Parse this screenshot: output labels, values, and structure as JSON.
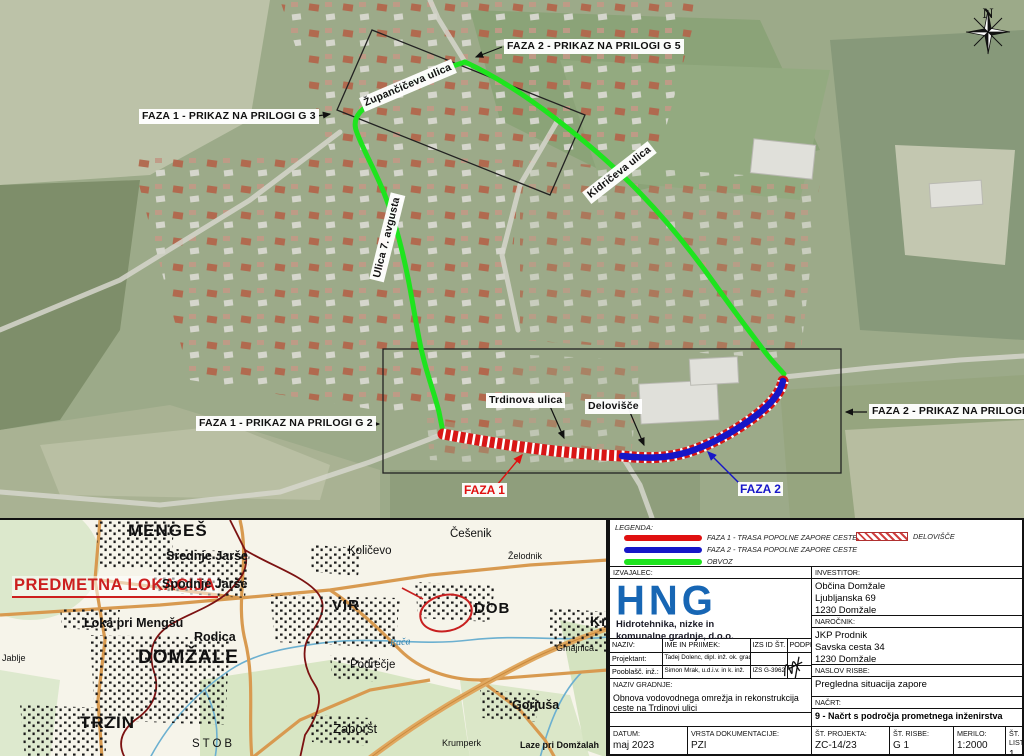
{
  "aerial": {
    "labels": {
      "faza2_g5": "FAZA 2 - PRIKAZ NA PRILOGI G 5",
      "faza1_g3": "FAZA 1 - PRIKAZ NA PRILOGI G 3",
      "faza1_g2": "FAZA 1 - PRIKAZ NA PRILOGI G 2",
      "faza2_g4": "FAZA 2 - PRIKAZ NA PRILOGI G 4",
      "street_zupanciceva": "Župančičeva ulica",
      "street_kidriceva": "Kidričeva ulica",
      "street_ulica7": "Ulica 7. avgusta",
      "street_trdinova": "Trdinova ulica",
      "delovisce": "Delovišče",
      "faza1": "FAZA 1",
      "faza2": "FAZA 2",
      "north": "N"
    },
    "colors": {
      "obvoz": "#1ee41e",
      "faza1": "#e01010",
      "faza2": "#1616c8"
    }
  },
  "map": {
    "highlight": "PREDMETNA LOKACIJA",
    "places": [
      "MENGEŠ",
      "Srednje Jarše",
      "Spodnje Jarše",
      "Količevo",
      "Češenik",
      "Želodnik",
      "Loka pri Mengšu",
      "Rodica",
      "VIR",
      "DOB",
      "Krtina",
      "DOMŽALE",
      "Podrečje",
      "Gmajnica",
      "TRZIN",
      "Zaboršt",
      "Gorjuša",
      "STOB",
      "Laze pri Domžalah",
      "Krumperk",
      "Rača",
      "Jablje"
    ]
  },
  "legend": {
    "title": "LEGENDA:",
    "items": [
      {
        "label": "FAZA 1 - TRASA POPOLNE ZAPORE CESTE",
        "color": "#e01010"
      },
      {
        "label": "FAZA 2 - TRASA POPOLNE ZAPORE CESTE",
        "color": "#1616c8"
      },
      {
        "label": "OBVOZ",
        "color": "#1ee41e"
      },
      {
        "label": "DELOVIŠČE",
        "swatch": "hatched"
      }
    ]
  },
  "titleblock": {
    "izvajalec_label": "IZVAJALEC:",
    "logo_text": "HNG",
    "logo_sub1": "Hidrotehnika, nizke in",
    "logo_sub2": "komunalne gradnje, d.o.o.",
    "investitor_label": "INVESTITOR:",
    "investitor1": "Občina Domžale",
    "investitor2": "Ljubljanska 69",
    "investitor3": "1230 Domžale",
    "narocnik_label": "NAROČNIK:",
    "narocnik1": "JKP Prodnik",
    "narocnik2": "Savska cesta 34",
    "narocnik3": "1230 Domžale",
    "col_naziv": "NAZIV:",
    "col_ime": "IME IN PRIIMEK:",
    "col_izs": "IZS ID ŠT.",
    "col_podpis": "PODPIS",
    "row1_naziv": "Projektant:",
    "row1_ime": "Tadej Dolenc, dipl. inž. ok. grad. (UN)",
    "row1_izs": "",
    "row2_naziv": "Pooblašč. inž.:",
    "row2_ime": "Simon Mrak, u.d.i.v. in k. inž.",
    "row2_izs": "IZS G-3962",
    "naziv_gradnje_label": "NAZIV GRADNJE:",
    "naziv_gradnje": "Obnova vodovodnega omrežja in rekonstrukcija ceste na Trdinovi ulici",
    "naslov_risbe_label": "NASLOV RISBE:",
    "naslov_risbe": "Pregledna situacija zapore",
    "nacrt_label": "NAČRT:",
    "nacrt": "9 - Načrt s področja prometnega inženirstva",
    "datum_label": "DATUM:",
    "datum": "maj 2023",
    "vrsta_label": "VRSTA DOKUMENTACIJE:",
    "vrsta": "PZI",
    "st_projekta_label": "ŠT. PROJEKTA:",
    "st_projekta": "ZC-14/23",
    "st_risbe_label": "ŠT. RISBE:",
    "st_risbe": "G 1",
    "merilo_label": "MERILO:",
    "merilo": "1:2000",
    "st_lista_label": "ŠT. LISTA:",
    "st_lista": "1"
  }
}
